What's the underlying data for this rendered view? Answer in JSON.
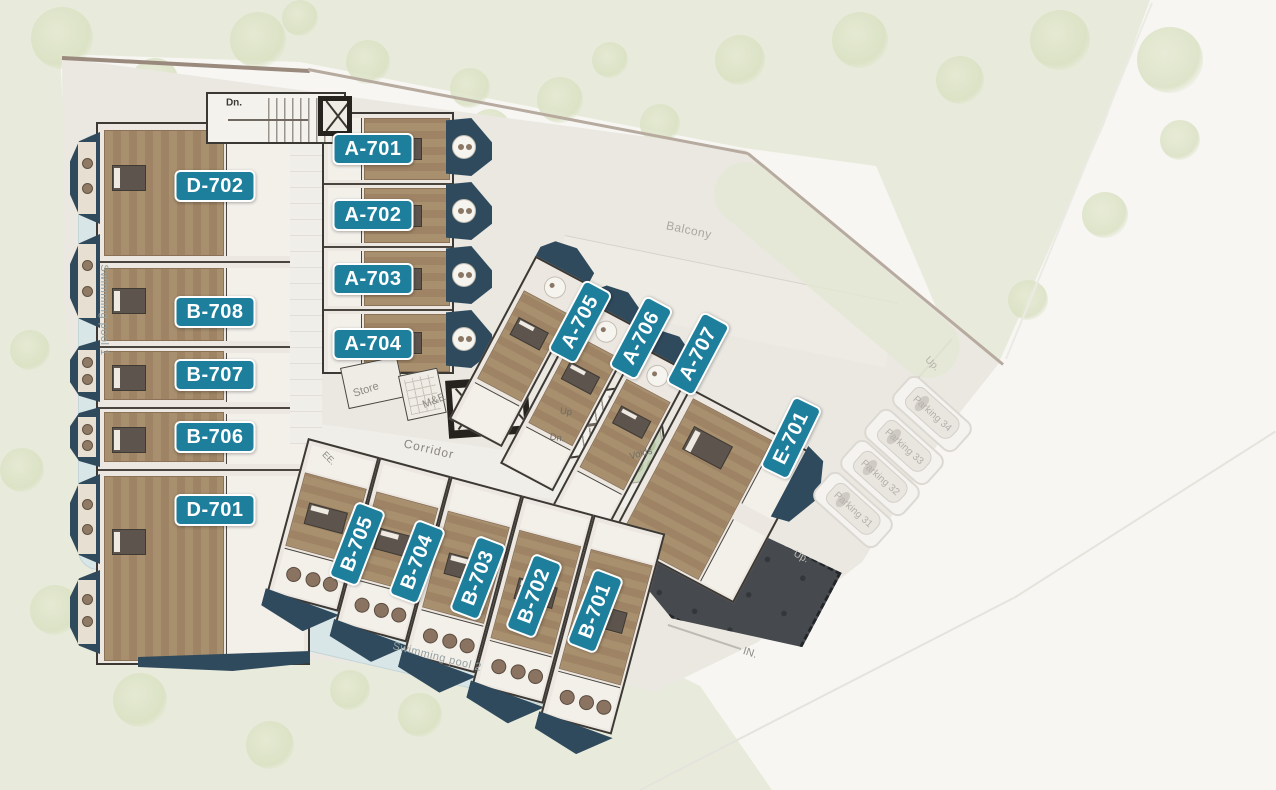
{
  "plan": {
    "units": [
      "D-702",
      "B-708",
      "B-707",
      "B-706",
      "D-701",
      "A-701",
      "A-702",
      "A-703",
      "A-704",
      "A-705",
      "A-706",
      "A-707",
      "E-701",
      "B-705",
      "B-704",
      "B-703",
      "B-702",
      "B-701"
    ],
    "labels": {
      "stair_top_dn": "Dn.",
      "store": "Store",
      "mne": "M&E",
      "corridor": "Corridor",
      "ee": "EE.",
      "stair_up": "Up",
      "stair_dn": "Dn.",
      "voids": "Voids",
      "balcony": "Balcony",
      "pool1": "Swimming pool 1",
      "pool2": "Swimming pool 2",
      "in_marker": "IN.",
      "ramp_up": "Up.",
      "deck_up": "Up.",
      "parking": [
        "Parking 34",
        "Parking 33",
        "Parking 32",
        "Parking 31"
      ]
    },
    "colors": {
      "unit_badge": "#1e7f9d",
      "badge_border": "#ffffff",
      "balcony_navy": "#304a5d",
      "wood_floor": "#a8906f",
      "pool_water": "#d8e6e8",
      "landscape_green": "#e8ebdb",
      "courtyard": "#eae8e1",
      "deck_dark": "#46494d"
    }
  }
}
